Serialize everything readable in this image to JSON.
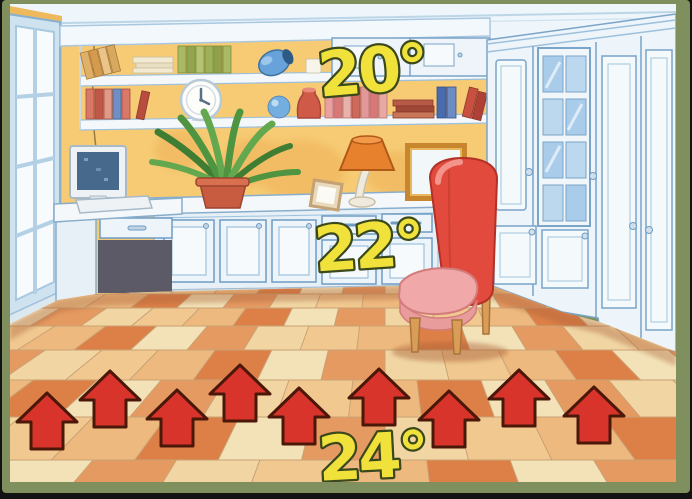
{
  "illustration": {
    "description": "room-heating-temperature-diagram",
    "temperatures": {
      "ceiling": "20°",
      "mid_room": "22°",
      "floor": "24°"
    },
    "heat_arrows": {
      "icon": "up-arrow-icon",
      "count": 9,
      "fill": "#d8342b",
      "outline": "#4a1708"
    },
    "labels_style": {
      "fill": "#f1e23b",
      "outline": "#3a481c"
    },
    "palette": {
      "frame": "#7f905e",
      "background": "#131313",
      "ceiling": "#eef5fb",
      "wall": "#f6cb74",
      "wall_left": "#eeb95c",
      "furniture": "#edf4fa",
      "furniture_line": "#6f9cc4",
      "tile_palette": [
        "#f1d6a4",
        "#e59a62",
        "#f3e2b8",
        "#dd8048",
        "#eeb97f",
        "#f0c890"
      ],
      "tile_grout": "#c9a274",
      "chair": "#e14a3c",
      "chair_seat": "#f0a8a8",
      "wood": "#d99d58",
      "plant": "#4f9440",
      "pot": "#c85c40",
      "lamp_shade": "#e8812e",
      "glass": "#a9cceb"
    },
    "objects": [
      "window",
      "bookshelves",
      "books",
      "clock",
      "blue-vase",
      "red-vase",
      "blue-ball",
      "computer-monitor",
      "keyboard",
      "desk",
      "potted-plant",
      "table-lamp",
      "picture-frame",
      "mirror",
      "upholstered-chair",
      "sideboard-cabinets",
      "wardrobe",
      "glass-cabinet-door",
      "tiled-floor",
      "heat-arrows"
    ]
  }
}
